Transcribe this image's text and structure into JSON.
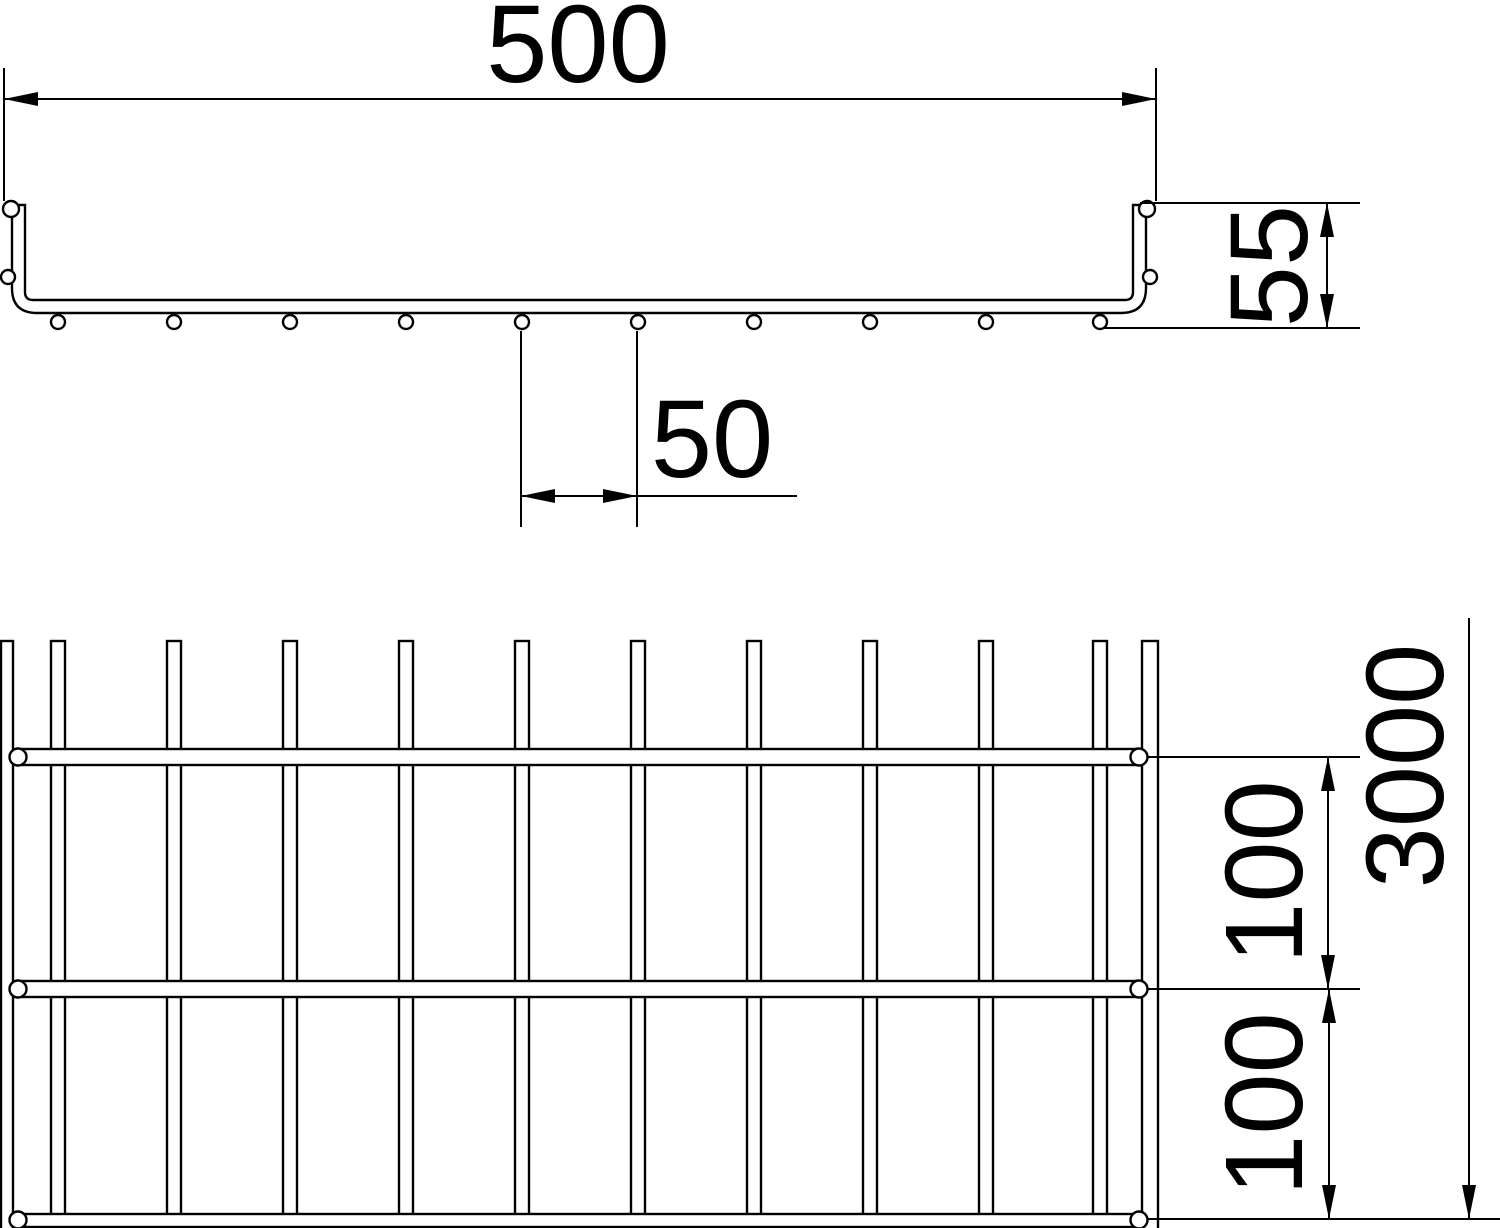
{
  "page": {
    "background": "#ffffff",
    "line_color": "#000000"
  },
  "cross_section_view": {
    "dim_overall_width": "500",
    "dim_side_height": "55",
    "dim_wire_pitch": "50"
  },
  "plan_view": {
    "dim_rung_spacing_upper": "100",
    "dim_rung_spacing_lower": "100",
    "dim_overall_length": "3000"
  }
}
